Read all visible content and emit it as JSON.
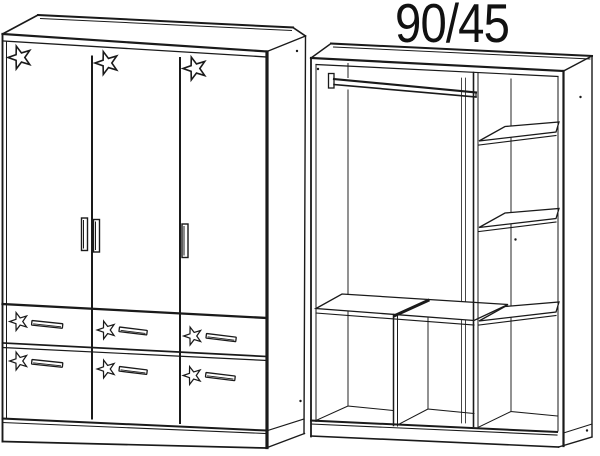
{
  "figure": {
    "dimension_label": "90/45",
    "background_color": "#ffffff",
    "line_color": "#1a1a1a",
    "front_view": {
      "doors": 3,
      "drawers": 6,
      "star_decorations": 9,
      "door_handles": 3,
      "drawer_handles": 6
    },
    "interior_view": {
      "hanging_rails": 1,
      "side_shelves": 3,
      "long_shelves": 1,
      "vertical_partitions": 2,
      "bottom_compartments": 3
    }
  }
}
